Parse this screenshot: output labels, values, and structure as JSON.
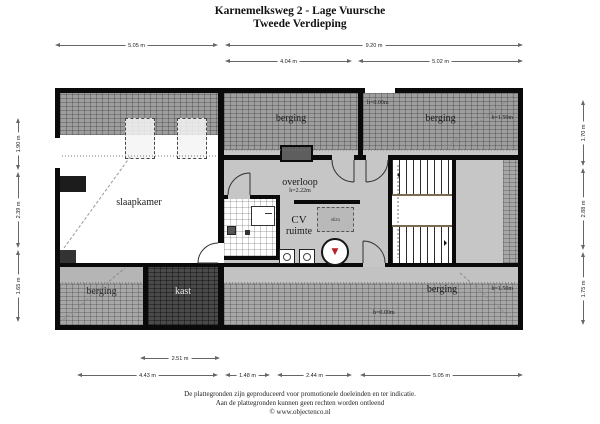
{
  "title": {
    "line1": "Karnemelksweg 2 - Lage Vuursche",
    "line2": "Tweede Verdieping"
  },
  "rooms": {
    "berging_top_left": {
      "label": "berging"
    },
    "berging_top_right": {
      "label": "berging",
      "h_top": "h=0.00m",
      "h_right": "h=1.50m"
    },
    "slaapkamer": {
      "label": "slaapkamer"
    },
    "overloop": {
      "label": "overloop",
      "height": "h=2.22m"
    },
    "cv_ruimte": {
      "line1": "CV",
      "line2": "ruimte",
      "vlizo_label": "vlizo"
    },
    "kast": {
      "label": "kast"
    },
    "berging_bottom_left": {
      "label": "berging"
    },
    "berging_bottom_right": {
      "label": "berging",
      "h_right": "h=1.50m",
      "h_bottom": "h=0.00m"
    }
  },
  "dimensions": {
    "top_row1": [
      "5.05 m",
      "9.20 m"
    ],
    "top_row2": [
      "4.04 m",
      "5.02 m"
    ],
    "bottom_row1": [
      "2.51 m"
    ],
    "bottom_row2": [
      "4.43 m",
      "1.48 m",
      "2.44 m",
      "5.05 m"
    ],
    "left": [
      "1.90 m",
      "2.39 m",
      "1.65 m"
    ],
    "right": [
      "1.70 m",
      "2.88 m",
      "1.75 m"
    ]
  },
  "icons": {
    "boiler_glyph": "▼"
  },
  "colors": {
    "boiler_red": "#b5242a",
    "wall_black": "#0a0a0a",
    "floor_gray": "#c6c6c6"
  },
  "footer": {
    "line1": "De plattegronden zijn geproduceerd voor promotionele doeleinden en ter indicatie.",
    "line2": "Aan de plattegronden kunnen geen rechten worden ontleend",
    "line3": "© www.objectenco.nl"
  }
}
